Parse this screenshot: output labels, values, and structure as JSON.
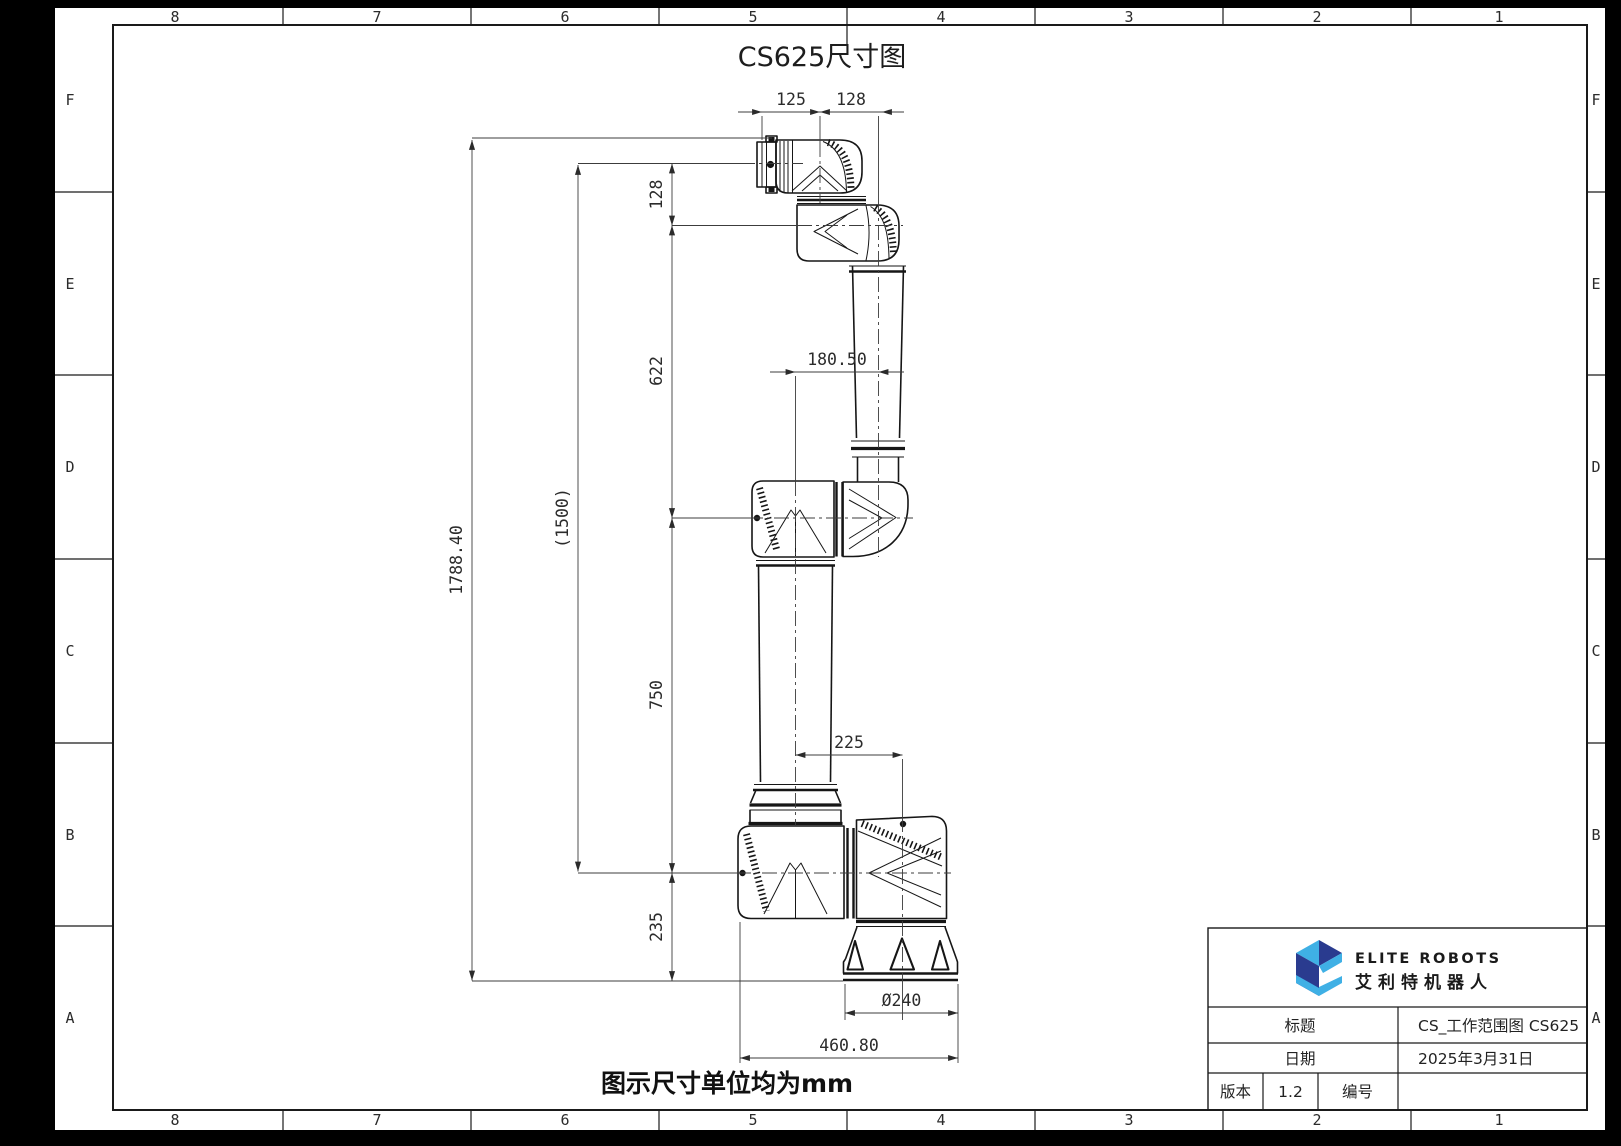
{
  "drawing_title": "CS625尺寸图",
  "note": "图示尺寸单位均为mm",
  "frame": {
    "columns": [
      "8",
      "7",
      "6",
      "5",
      "4",
      "3",
      "2",
      "1"
    ],
    "rows": [
      "F",
      "E",
      "D",
      "C",
      "B",
      "A"
    ]
  },
  "dimensions": {
    "top_flange_offset": "125",
    "top_wrist_offset": "128",
    "overall_height": "1788.40",
    "reach_reference": "(1500)",
    "wrist_segment": "128",
    "upper_arm_segment": "622",
    "lower_arm_segment": "750",
    "base_segment": "235",
    "arm_centerline_offset": "180.50",
    "shoulder_base_offset": "225",
    "base_diameter": "Ø240",
    "base_width": "460.80"
  },
  "title_block": {
    "brand_en": "ELITE ROBOTS",
    "brand_cn": "艾利特机器人",
    "title_label": "标题",
    "title_value": "CS_工作范围图 CS625",
    "date_label": "日期",
    "date_value": "2025年3月31日",
    "version_label": "版本",
    "version_value": "1.2",
    "number_label": "编号",
    "number_value": ""
  },
  "colors": {
    "logo_dark": "#2a3b8f",
    "logo_light": "#3fb0e5",
    "sheet": "#ffffff"
  }
}
